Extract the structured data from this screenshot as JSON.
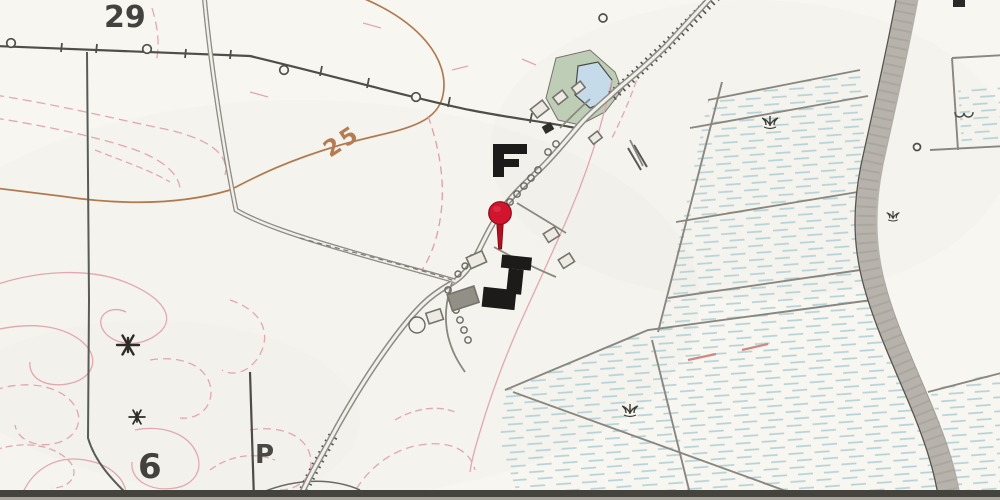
{
  "map": {
    "type": "historical-topographic-map",
    "labels": {
      "parcel_top": "29",
      "parcel_bottom": "6",
      "contour_elevation": "25",
      "boundary_letter": "P"
    },
    "marker": {
      "name": "location-pin",
      "x": 500,
      "y": 214
    },
    "palette": {
      "paper": "#f8f6f1",
      "road_gray": "#8f8c85",
      "boundary_dark": "#4e4c47",
      "contour_pink": "#e2a3ad",
      "contour_brown": "#b07a50",
      "water_blue": "#c6dbe9",
      "marsh_green": "#bccdb4",
      "meadow_hatch": "#b5d2d8",
      "dike_gray": "#b7b3ac",
      "building_black": "#1c1b19",
      "pin_red": "#d2152f"
    },
    "features": [
      "parish-boundary-lines",
      "village-roads",
      "tree-lined-lanes",
      "black-farm-buildings",
      "pond-with-marsh",
      "stream-dike-band",
      "hatched-wet-meadows",
      "pink-contour-lines",
      "brown-index-contour",
      "windmill-symbols",
      "marsh-tuft-symbols",
      "red-location-pin"
    ]
  }
}
